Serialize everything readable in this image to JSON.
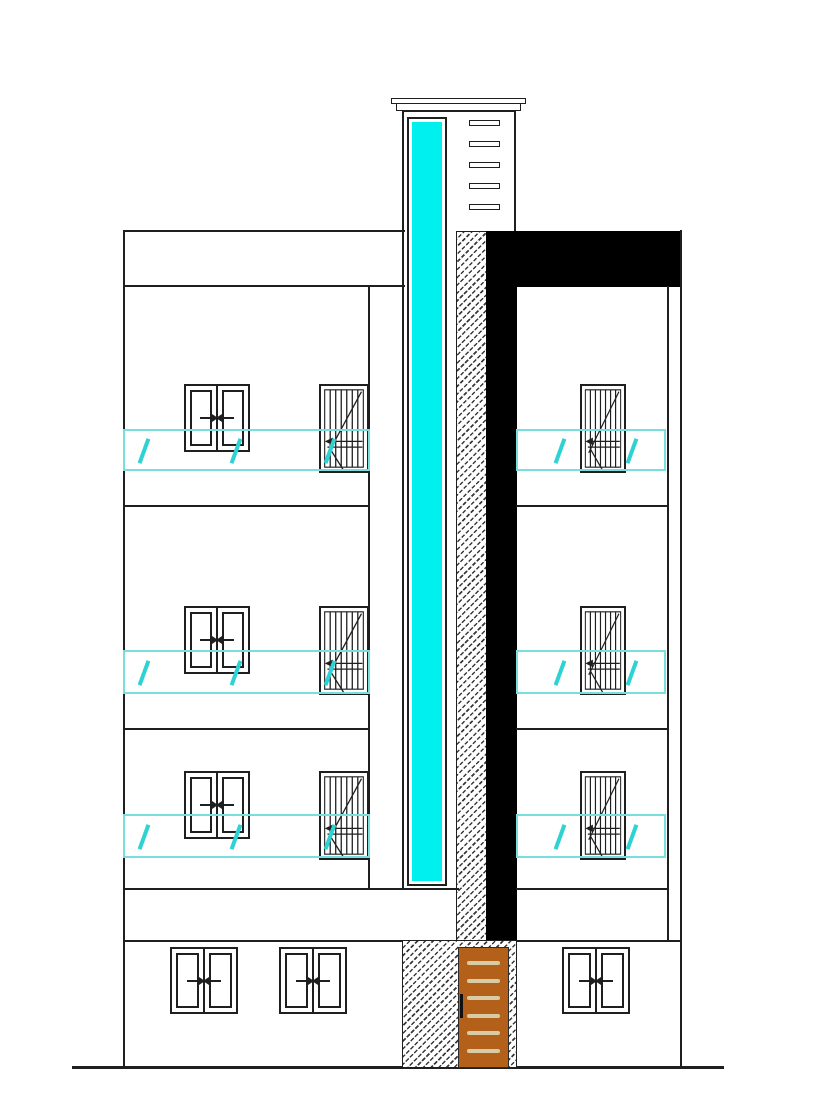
{
  "meta": {
    "title": "Building front elevation — CAD line drawing",
    "visible_text": "none"
  },
  "colors": {
    "line": "#1f1f1f",
    "glass": "#00efef",
    "band": "#79dede",
    "slash": "#2ed2d2",
    "door": "#b2601a",
    "door-stripe": "#d9cba4",
    "black": "#000000",
    "paper": "#ffffff"
  },
  "tower": {
    "louver_count": 5,
    "glazing": "full-height cyan glass strip",
    "cap": "stepped cornice"
  },
  "shaft": {
    "hatched_column": true,
    "black_column": true,
    "black_parapet_band": true
  },
  "facade": {
    "upper_floors": 3,
    "double_sliding_windows_upper": 3,
    "stair_windows": 6,
    "glass_balustrade_bands": 6,
    "ground_floor_windows": 3
  },
  "door": {
    "stripe_count": 6,
    "has_handle": true
  }
}
